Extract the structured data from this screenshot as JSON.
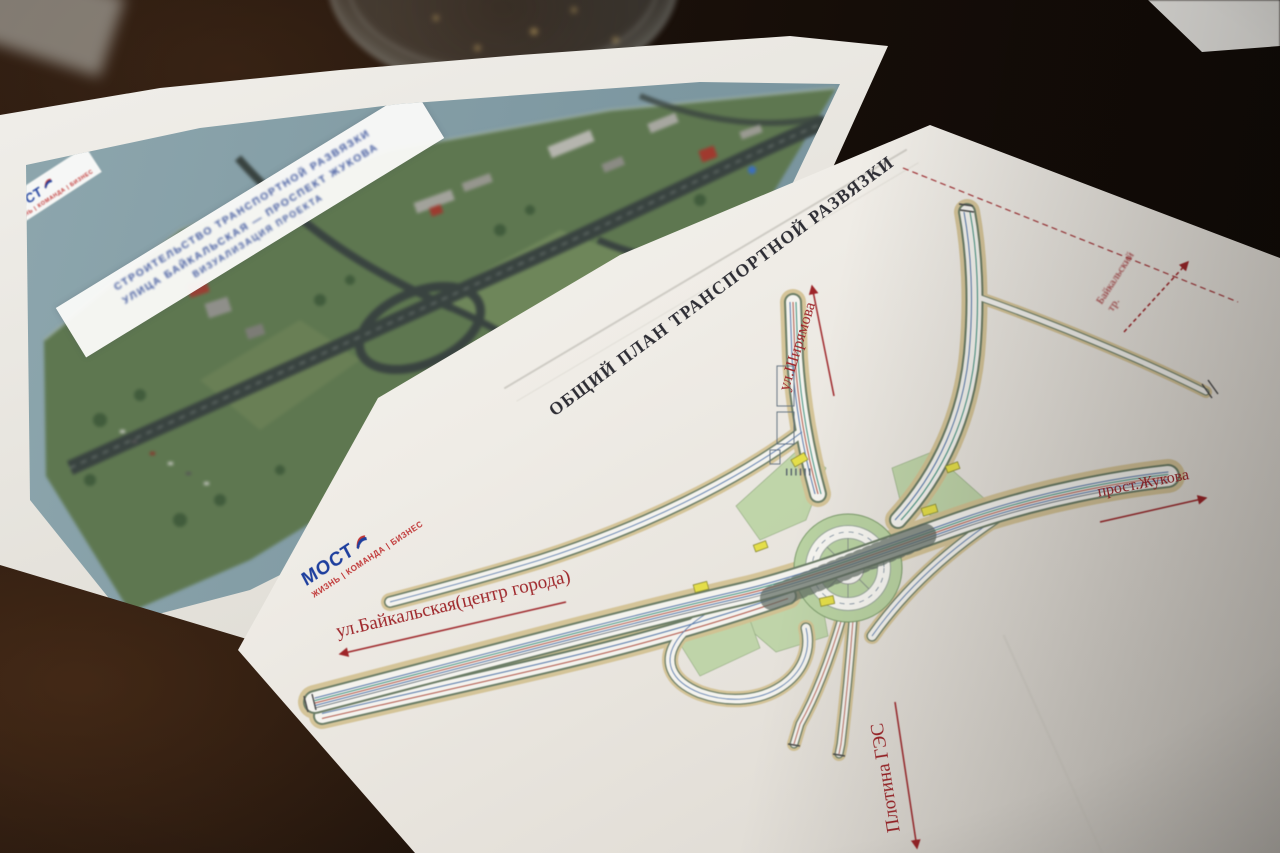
{
  "scene": {
    "description": "Photograph of printed road-interchange drawings lying on a dark wooden table with a glass tumbler behind them"
  },
  "back_sheet": {
    "title_lines": [
      "СТРОИТЕЛЬСТВО ТРАНСПОРТНОЙ РАЗВЯЗКИ",
      "УЛИЦА БАЙКАЛЬСКАЯ — ПРОСПЕКТ ЖУКОВА",
      "ВИЗУАЛИЗАЦИЯ ПРОЕКТА"
    ],
    "logo_text": "МОСТ",
    "logo_tagline": "ЖИЗНЬ | КОМАНДА | БИЗНЕС"
  },
  "front_sheet": {
    "title": "ОБЩИЙ ПЛАН ТРАНСПОРТНОЙ РАЗВЯЗКИ",
    "logo_text": "МОСТ",
    "logo_tagline": "ЖИЗНЬ | КОМАНДА | БИЗНЕС",
    "labels": {
      "baikalskaya": "ул.Байкальская(центр города)",
      "shiryamova": "ул.Ширямова",
      "zhukova": "прост.Жукова",
      "baikal_trakt_1": "Байкальский",
      "baikal_trakt_2": "тр.",
      "plotina": "Плотина ГЭС"
    },
    "colors": {
      "label_red": "#9e2529",
      "logo_blue": "#1e3f9e",
      "logo_red": "#c03535",
      "island_green": "#b9d2a2",
      "embankment_tan": "#d2c091"
    }
  }
}
